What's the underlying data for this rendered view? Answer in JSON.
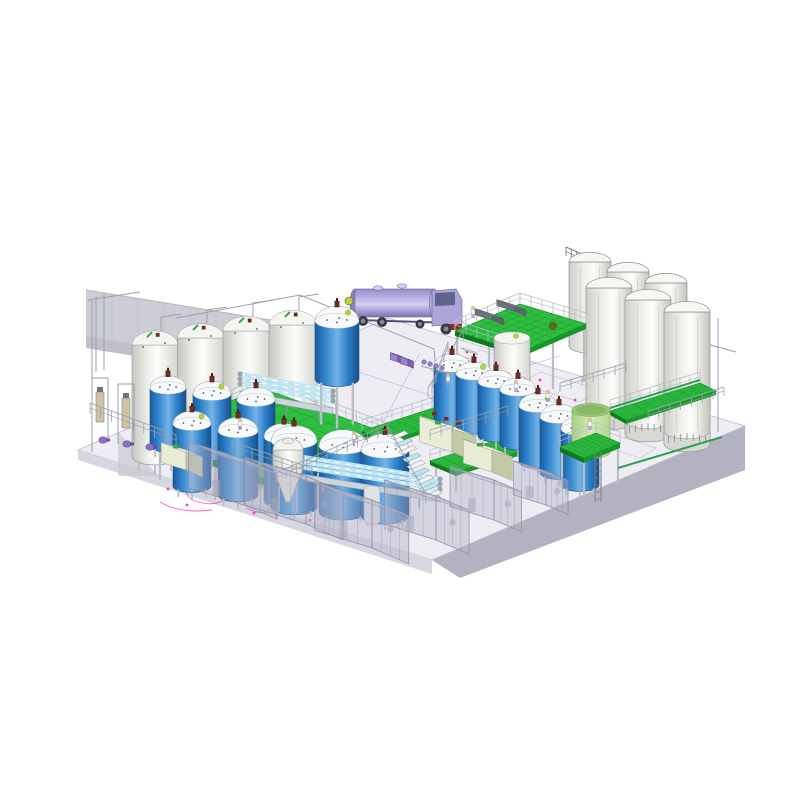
{
  "meta": {
    "description": "isometric 3d cad render of a liquid process plant with tanks, silos, platforms and tanker truck",
    "canvas": [
      800,
      800
    ]
  },
  "palette": {
    "background": "#ffffff",
    "floor_top": "#ededf3",
    "floor_stroke": "#c7c7d4",
    "floor_face_light": "#d7d7e1",
    "floor_face_dark": "#b2b2c0",
    "wall": "#cdcdd6",
    "wall_dark": "#c0c0ca",
    "wall_line": "#b1b1bc",
    "green_deck": "#2fbd42",
    "green_deck_dark": "#17962b",
    "green_edge": "#0e7a1f",
    "tank_blue_dark": "#1b5c9c",
    "tank_blue_mid": "#2b7fc8",
    "tank_blue_light": "#74b3e8",
    "dome_white": "#f7f9fb",
    "white_tank_light": "#fcfcfa",
    "white_tank_dark": "#c6c6c1",
    "silo_light": "#fdfdfb",
    "silo_dark": "#c3c3be",
    "silo_stroke": "#8f9096",
    "truck_light": "#d4cdf2",
    "truck_mid": "#ada4dc",
    "truck_dark": "#7d74b0",
    "pale_green_light": "#d6edb8",
    "pale_green_dark": "#a8cf82",
    "pale_green_rim": "#86b45e",
    "beige_light": "#e9edd6",
    "beige_mid": "#dde3c4",
    "beige_dark": "#c2c9a6",
    "agitator": "#6e2c1e",
    "valve_green": "#b8d43a",
    "valve_green_dark": "#7fa01f",
    "purple": "#8f6fc0",
    "purple_dark": "#6b4fa0",
    "people_pants": "#ab97d6",
    "people_skin": "#e6c29a",
    "pink": "#ee3fc0",
    "red_mark": "#d03a2a",
    "floor_blue_line": "#8aa6d6",
    "tube_blue": "#bfe5f2",
    "tube_frame": "#8e99a4",
    "pipe": "#9aa0aa",
    "pipe_green": "#2f9e57",
    "rail": "#9aa2ac",
    "leg": "#b9bdc4",
    "enclosure_fill": "rgba(178,178,200,0.42)",
    "enclosure_top": "rgba(205,205,220,0.5)",
    "enclosure_line": "#8e8ea2",
    "hatch_gray": "#7e838c",
    "steel": "#8f949b",
    "door": "#9a9aa6",
    "door_line": "#55555f"
  },
  "scene": {
    "floor": {
      "top": [
        [
          78,
          450
        ],
        [
          388,
          318
        ],
        [
          745,
          426
        ],
        [
          432,
          560
        ]
      ],
      "right_face": [
        [
          432,
          560
        ],
        [
          745,
          426
        ],
        [
          745,
          470
        ],
        [
          460,
          578
        ]
      ],
      "left_face": [
        [
          78,
          450
        ],
        [
          432,
          560
        ],
        [
          432,
          574
        ],
        [
          78,
          460
        ]
      ],
      "ramp": [
        [
          118,
          432
        ],
        [
          158,
          476
        ],
        [
          118,
          476
        ]
      ]
    },
    "wall": {
      "main": [
        [
          86,
          290
        ],
        [
          466,
          352
        ],
        [
          466,
          410
        ],
        [
          86,
          348
        ]
      ],
      "lower": [
        [
          86,
          336
        ],
        [
          466,
          398
        ],
        [
          466,
          410
        ],
        [
          86,
          348
        ]
      ],
      "door": [
        428,
        342,
        20,
        30
      ],
      "door_figure": [
        419,
        372
      ],
      "seam_step": 26
    },
    "silos": {
      "back": [
        [
          590,
          262,
          42,
          84
        ],
        [
          628,
          272,
          42,
          86
        ],
        [
          666,
          283,
          42,
          88
        ]
      ],
      "front": [
        [
          609,
          288,
          46,
          134
        ],
        [
          648,
          300,
          46,
          134
        ],
        [
          687,
          312,
          46,
          132
        ]
      ],
      "railing": [
        566,
        256,
        704,
        318,
        26,
        9
      ]
    },
    "white_tanks": [
      [
        155,
        345,
        46,
        112
      ],
      [
        201,
        338,
        47,
        114
      ],
      [
        247,
        331,
        48,
        116
      ],
      [
        293,
        325,
        48,
        118
      ]
    ],
    "center_white_tank": [
      512,
      338,
      36,
      66
    ],
    "blue_tanks": [
      [
        168,
        388,
        36,
        58,
        8,
        1,
        0
      ],
      [
        212,
        394,
        38,
        60,
        8,
        1,
        1
      ],
      [
        256,
        400,
        38,
        60,
        8,
        1,
        0
      ],
      [
        192,
        424,
        38,
        62,
        8,
        1,
        1
      ],
      [
        238,
        431,
        40,
        64,
        8,
        1,
        0
      ],
      [
        284,
        437,
        40,
        64,
        8,
        1,
        1
      ],
      [
        294,
        441,
        46,
        66,
        6,
        1,
        0
      ],
      [
        343,
        446,
        48,
        66,
        6,
        0,
        1
      ],
      [
        385,
        450,
        48,
        66,
        6,
        1,
        0
      ],
      [
        337,
        321,
        44,
        58,
        42,
        1,
        1
      ],
      [
        452,
        366,
        36,
        54,
        7,
        1,
        0
      ],
      [
        474,
        374,
        36,
        54,
        7,
        1,
        1
      ],
      [
        496,
        382,
        36,
        54,
        7,
        1,
        0
      ],
      [
        518,
        390,
        36,
        54,
        7,
        1,
        0
      ],
      [
        538,
        406,
        38,
        56,
        7,
        1,
        1
      ],
      [
        559,
        417,
        38,
        56,
        7,
        1,
        0
      ],
      [
        580,
        429,
        38,
        56,
        7,
        0,
        1
      ]
    ],
    "platforms": [
      {
        "pts": [
          [
            152,
            434
          ],
          [
            262,
            388
          ],
          [
            388,
            434
          ],
          [
            276,
            483
          ]
        ],
        "h": 8,
        "legs": [
          [
            160,
            440,
            40
          ],
          [
            276,
            483,
            36
          ],
          [
            380,
            438,
            40
          ],
          [
            215,
            462,
            38
          ],
          [
            330,
            460,
            38
          ]
        ],
        "rails": [
          [
            0,
            1
          ],
          [
            1,
            2
          ],
          [
            3,
            2
          ]
        ]
      },
      {
        "pts": [
          [
            362,
            431
          ],
          [
            452,
            402
          ],
          [
            476,
            412
          ],
          [
            386,
            442
          ]
        ],
        "h": 4,
        "legs": [
          [
            368,
            434,
            22
          ],
          [
            386,
            442,
            22
          ],
          [
            470,
            414,
            22
          ]
        ],
        "rails": [
          [
            0,
            1
          ]
        ]
      },
      {
        "pts": [
          [
            430,
            461
          ],
          [
            520,
            433
          ],
          [
            546,
            443
          ],
          [
            456,
            472
          ]
        ],
        "h": 4,
        "legs": [
          [
            436,
            463,
            20
          ],
          [
            456,
            472,
            20
          ],
          [
            540,
            445,
            20
          ]
        ],
        "rails": [
          [
            0,
            1
          ],
          [
            1,
            2
          ]
        ]
      },
      {
        "pts": [
          [
            610,
            411
          ],
          [
            700,
            383
          ],
          [
            716,
            391
          ],
          [
            626,
            420
          ]
        ],
        "h": 4,
        "legs": [
          [
            614,
            413,
            18
          ],
          [
            626,
            420,
            18
          ],
          [
            710,
            393,
            18
          ]
        ],
        "rails": [
          [
            0,
            1
          ]
        ]
      },
      {
        "pts": [
          [
            455,
            331
          ],
          [
            520,
            304
          ],
          [
            586,
            324
          ],
          [
            521,
            352
          ]
        ],
        "h": 5,
        "legs": [
          [
            457,
            334,
            62
          ],
          [
            521,
            352,
            52
          ],
          [
            584,
            326,
            56
          ],
          [
            489,
            343,
            56
          ],
          [
            553,
            339,
            50
          ]
        ],
        "rails": [
          [
            0,
            1
          ],
          [
            1,
            2
          ],
          [
            0,
            3
          ]
        ]
      },
      {
        "pts": [
          [
            560,
            447
          ],
          [
            596,
            433
          ],
          [
            620,
            443
          ],
          [
            584,
            458
          ]
        ],
        "h": 5,
        "legs": [
          [
            562,
            449,
            40
          ],
          [
            584,
            458,
            40
          ],
          [
            618,
            445,
            40
          ]
        ],
        "rails": [
          [
            0,
            1
          ],
          [
            1,
            2
          ]
        ]
      }
    ],
    "stairs": [
      {
        "x": 430,
        "y": 398,
        "dx": 4.4,
        "dy": -7.2,
        "n": 8,
        "wx": 13.4,
        "wy": 4.2
      },
      {
        "x": 390,
        "y": 437,
        "dx": 4.2,
        "dy": 7.4,
        "n": 9,
        "wx": 14.7,
        "wy": -6.3
      },
      {
        "x": 510,
        "y": 382,
        "dx": 4.2,
        "dy": 6.0,
        "n": 8,
        "wx": 12.9,
        "wy": -5.5
      }
    ],
    "ladder": [
      598,
      452,
      598,
      502
    ],
    "truck": {
      "barrel": [
        352,
        289,
        434,
        317
      ],
      "cab": [
        [
          432,
          291
        ],
        [
          456,
          289
        ],
        [
          462,
          300
        ],
        [
          462,
          324
        ],
        [
          432,
          326
        ]
      ],
      "window": [
        [
          435,
          293
        ],
        [
          455,
          292
        ],
        [
          455,
          305
        ],
        [
          435,
          306
        ]
      ],
      "wheels": [
        [
          363,
          321,
          5
        ],
        [
          382,
          322,
          5
        ],
        [
          420,
          324,
          4.5
        ],
        [
          446,
          329,
          5.5
        ]
      ],
      "fender": [
        445,
        324,
        17,
        6
      ],
      "manholes": [
        [
          378,
          288
        ],
        [
          402,
          286
        ]
      ]
    },
    "tube_machines": [
      [
        240,
        387,
        333,
        404,
        3
      ],
      [
        302,
        470,
        440,
        492,
        3
      ]
    ],
    "beige_boxes": [
      [
        452,
        452,
        34,
        26,
        26
      ],
      [
        492,
        472,
        30,
        22,
        24
      ],
      [
        186,
        470,
        26,
        18,
        20
      ]
    ],
    "hatches": [
      [
        492,
        320,
        18,
        13,
        6
      ],
      [
        514,
        311,
        18,
        13,
        6
      ]
    ],
    "purple_boxes": [
      [
        398,
        362,
        8,
        6,
        7
      ],
      [
        408,
        366,
        8,
        6,
        7
      ]
    ],
    "purple_bottles": [
      [
        424,
        362
      ],
      [
        430,
        364
      ],
      [
        436,
        366
      ],
      [
        442,
        368
      ]
    ],
    "vessels": {
      "conical": [
        [
          288,
          450
        ]
      ],
      "slim": [
        [
          372,
          486
        ]
      ]
    },
    "pale_tank": [
      591,
      410,
      38,
      42
    ],
    "enclosures": [
      [
        244,
        505,
        58,
        36,
        46
      ],
      [
        306,
        524,
        64,
        40,
        48
      ],
      [
        372,
        548,
        60,
        40,
        48
      ],
      [
        436,
        540,
        54,
        36,
        44
      ],
      [
        494,
        520,
        46,
        30,
        40
      ],
      [
        546,
        505,
        34,
        24,
        34
      ]
    ],
    "railings": [
      [
        90,
        414,
        176,
        446,
        11
      ],
      [
        232,
        452,
        312,
        478,
        10
      ],
      [
        430,
        440,
        508,
        416,
        10
      ],
      [
        560,
        392,
        626,
        372,
        9
      ],
      [
        648,
        420,
        724,
        396,
        9
      ],
      [
        448,
        352,
        432,
        394,
        10
      ],
      [
        276,
        483,
        388,
        434,
        10
      ]
    ],
    "pipes": {
      "gray": [
        [
          [
            161,
            339
          ],
          [
            161,
            317
          ],
          [
            181,
            314
          ]
        ],
        [
          [
            207,
            332
          ],
          [
            207,
            310
          ],
          [
            227,
            307
          ]
        ],
        [
          [
            253,
            325
          ],
          [
            253,
            303
          ],
          [
            273,
            300
          ]
        ],
        [
          [
            299,
            319
          ],
          [
            299,
            297
          ],
          [
            319,
            294
          ]
        ],
        [
          [
            176,
            318
          ],
          [
            300,
            295
          ],
          [
            434,
            349
          ],
          [
            438,
            392
          ]
        ],
        [
          [
            96,
            296
          ],
          [
            96,
            372
          ]
        ],
        [
          [
            104,
            294
          ],
          [
            104,
            370
          ]
        ],
        [
          [
            88,
            300
          ],
          [
            140,
            292
          ]
        ],
        [
          [
            718,
            318
          ],
          [
            718,
            432
          ]
        ],
        [
          [
            700,
            342
          ],
          [
            736,
            352
          ]
        ],
        [
          [
            92,
            300
          ],
          [
            92,
            452
          ]
        ]
      ],
      "green": [
        [
          [
            618,
            468
          ],
          [
            722,
            437
          ]
        ],
        [
          [
            610,
            408
          ],
          [
            700,
            380
          ]
        ]
      ]
    },
    "filter_columns": [
      [
        100,
        392
      ],
      [
        126,
        398
      ]
    ],
    "pumps": [
      [
        103,
        440
      ],
      [
        127,
        444
      ],
      [
        150,
        447
      ]
    ],
    "people": [
      [
        473,
        318
      ],
      [
        448,
        385
      ],
      [
        516,
        392
      ],
      [
        240,
        430
      ],
      [
        548,
        402
      ],
      [
        590,
        430
      ],
      [
        354,
        443
      ]
    ],
    "balls": [
      [
        349,
        301
      ],
      [
        553,
        326
      ]
    ],
    "red_valves": [
      [
        432,
        412
      ],
      [
        444,
        417
      ],
      [
        456,
        421
      ]
    ],
    "floor_marks": {
      "pink_paths": [
        "M188,486 q14,-8 30,-2 q16,6 8,14 q-10,9 -28,4 q-16,-5 -10,-16 Z",
        "M160,502 q20,12 52,8",
        "M246,508 q10,6 22,4"
      ],
      "pink_dots": [
        [
          168,
          489
        ],
        [
          187,
          505
        ],
        [
          254,
          513
        ],
        [
          284,
          503
        ],
        [
          310,
          520
        ],
        [
          336,
          486
        ],
        [
          575,
          400
        ],
        [
          540,
          380
        ]
      ],
      "red_dots": [
        [
          412,
          428
        ],
        [
          600,
          443
        ],
        [
          467,
          352
        ],
        [
          700,
          436
        ]
      ],
      "blue_lines": [
        [
          352,
          370,
          470,
          408
        ],
        [
          420,
          353,
          380,
          428
        ],
        [
          492,
          376,
          560,
          356
        ],
        [
          430,
          370,
          500,
          392
        ]
      ],
      "faint_rects": [
        [
          [
            540,
            372
          ],
          [
            600,
            390
          ],
          [
            580,
            402
          ],
          [
            520,
            384
          ]
        ],
        [
          [
            480,
            350
          ],
          [
            530,
            366
          ],
          [
            514,
            378
          ],
          [
            464,
            362
          ]
        ],
        [
          [
            600,
            430
          ],
          [
            656,
            448
          ],
          [
            640,
            458
          ],
          [
            584,
            440
          ]
        ]
      ]
    }
  }
}
